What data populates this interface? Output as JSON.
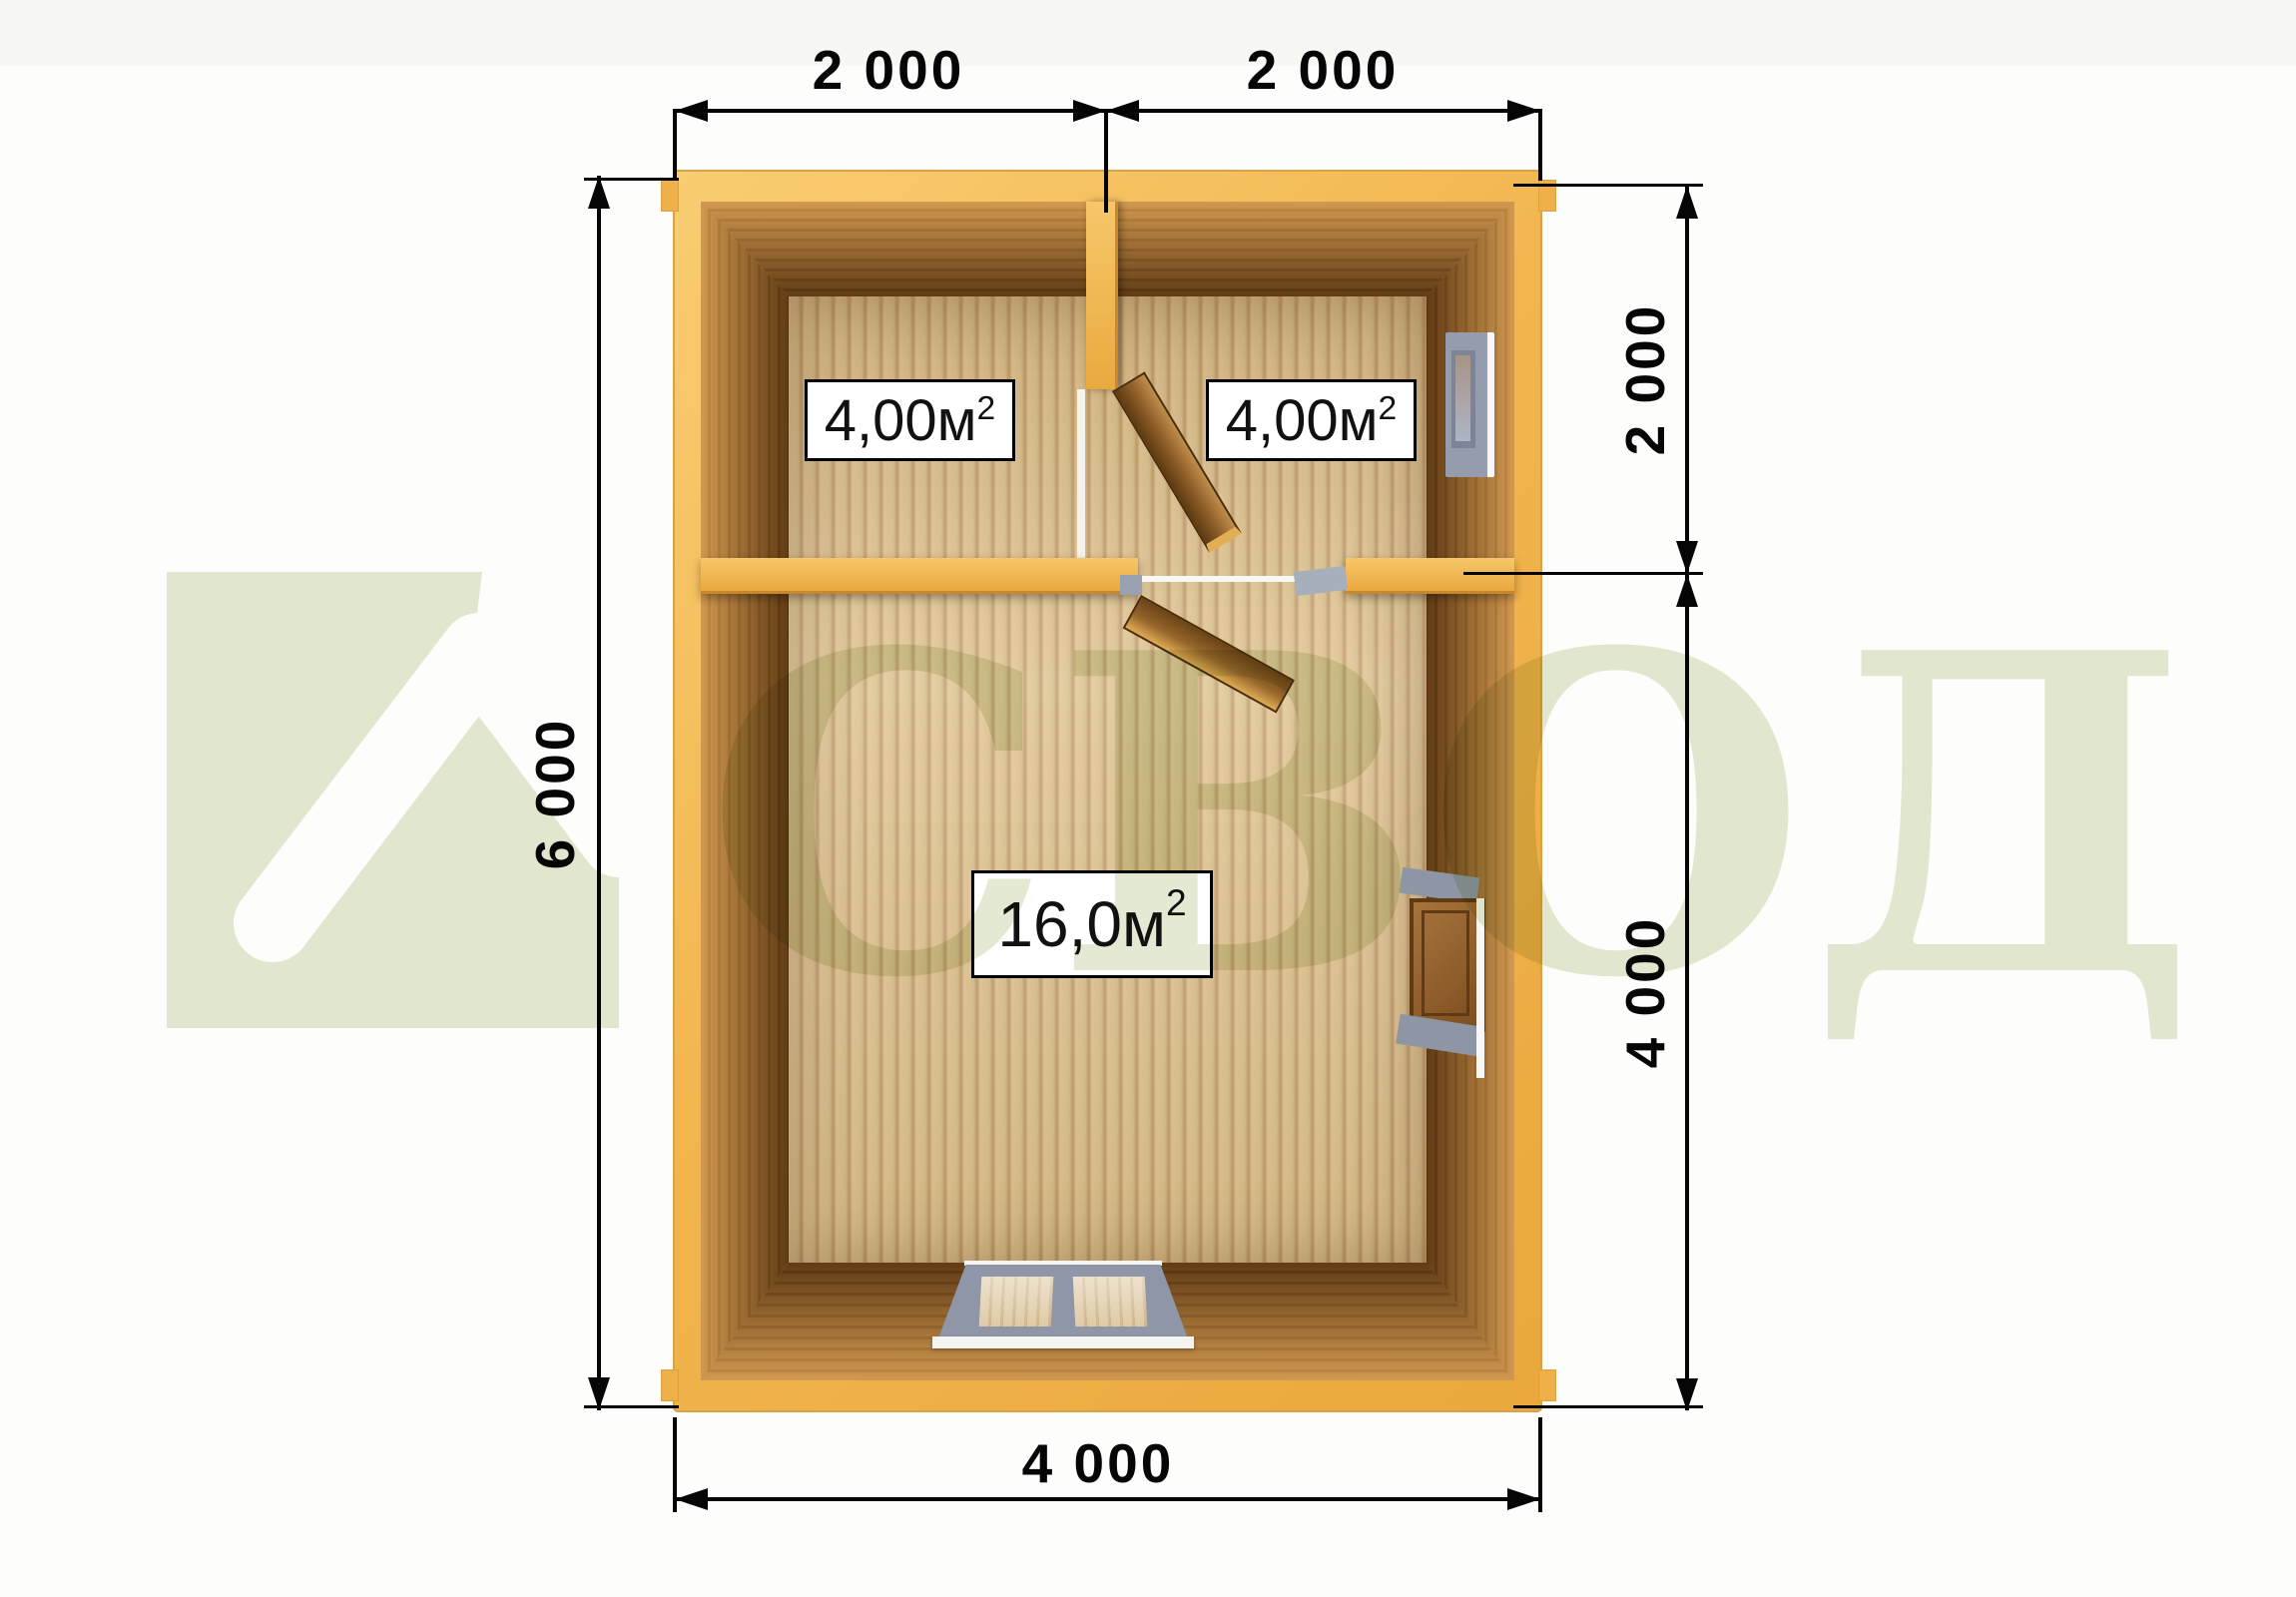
{
  "plan": {
    "rooms": [
      {
        "area": "4,00м",
        "sup": "2"
      },
      {
        "area": "4,00м",
        "sup": "2"
      },
      {
        "area": "16,0м",
        "sup": "2"
      }
    ]
  },
  "dimensions": {
    "top": [
      "2 000",
      "2 000"
    ],
    "left": [
      "6 000"
    ],
    "right": [
      "2 000",
      "4 000"
    ],
    "bottom": [
      "4 000"
    ]
  },
  "watermark": {
    "letters": [
      "С",
      "В",
      "О",
      "Д"
    ]
  },
  "icons": [
    "house-roof-icon"
  ],
  "colors": {
    "wall_yellow": "#f2b64f",
    "log_brown": "#82501d",
    "floor_tan": "#dabf8d",
    "watermark_green": "#e3e9d3",
    "window_gray": "#949cae",
    "line_black": "#050505"
  }
}
